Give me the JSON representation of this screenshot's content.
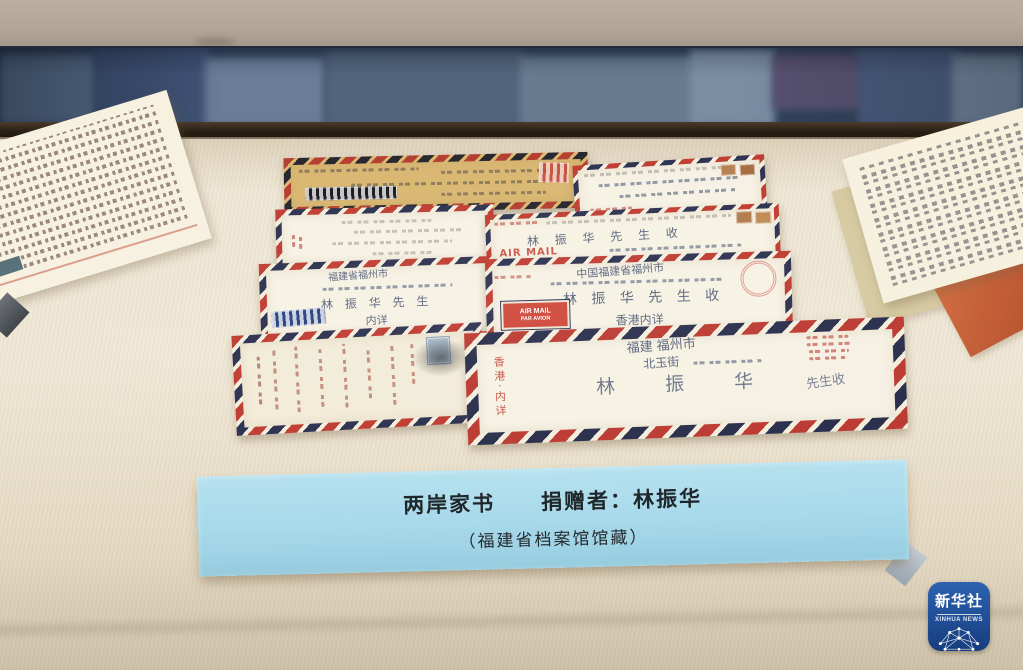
{
  "label_card": {
    "line1": "两岸家书　　捐赠者：林振华",
    "line2": "（福建省档案馆馆藏）"
  },
  "watermark": {
    "cn": "新华社",
    "en": "XINHUA NEWS"
  },
  "envelopes": {
    "row2_right": {
      "airmail": "AIR MAIL",
      "par_avion": "PAR AVION",
      "addressee": "林 振 华 先 生 收"
    },
    "row3_left": {
      "city": "福建省福州市",
      "addressee": "林 振 华 先 生",
      "note": "内详"
    },
    "row3_right": {
      "city": "中国福建省福州市",
      "addressee": "林 振 华 先 生 收",
      "origin": "香港内详",
      "label_top": "AIR MAIL",
      "label_bottom": "PAR AVION"
    },
    "row4_right": {
      "province_city": "福建 福州市",
      "street": "北玉街",
      "addressee": "林  振  华",
      "suffix": "先生收",
      "origin_vertical": "香港·内详"
    }
  },
  "colors": {
    "card_blue": "#a6d9ea",
    "stripe_red": "#bf3a2f",
    "stripe_navy": "#2a2f4e",
    "logo_blue": "#1c448a",
    "surface_beige": "#e9e0cc"
  }
}
